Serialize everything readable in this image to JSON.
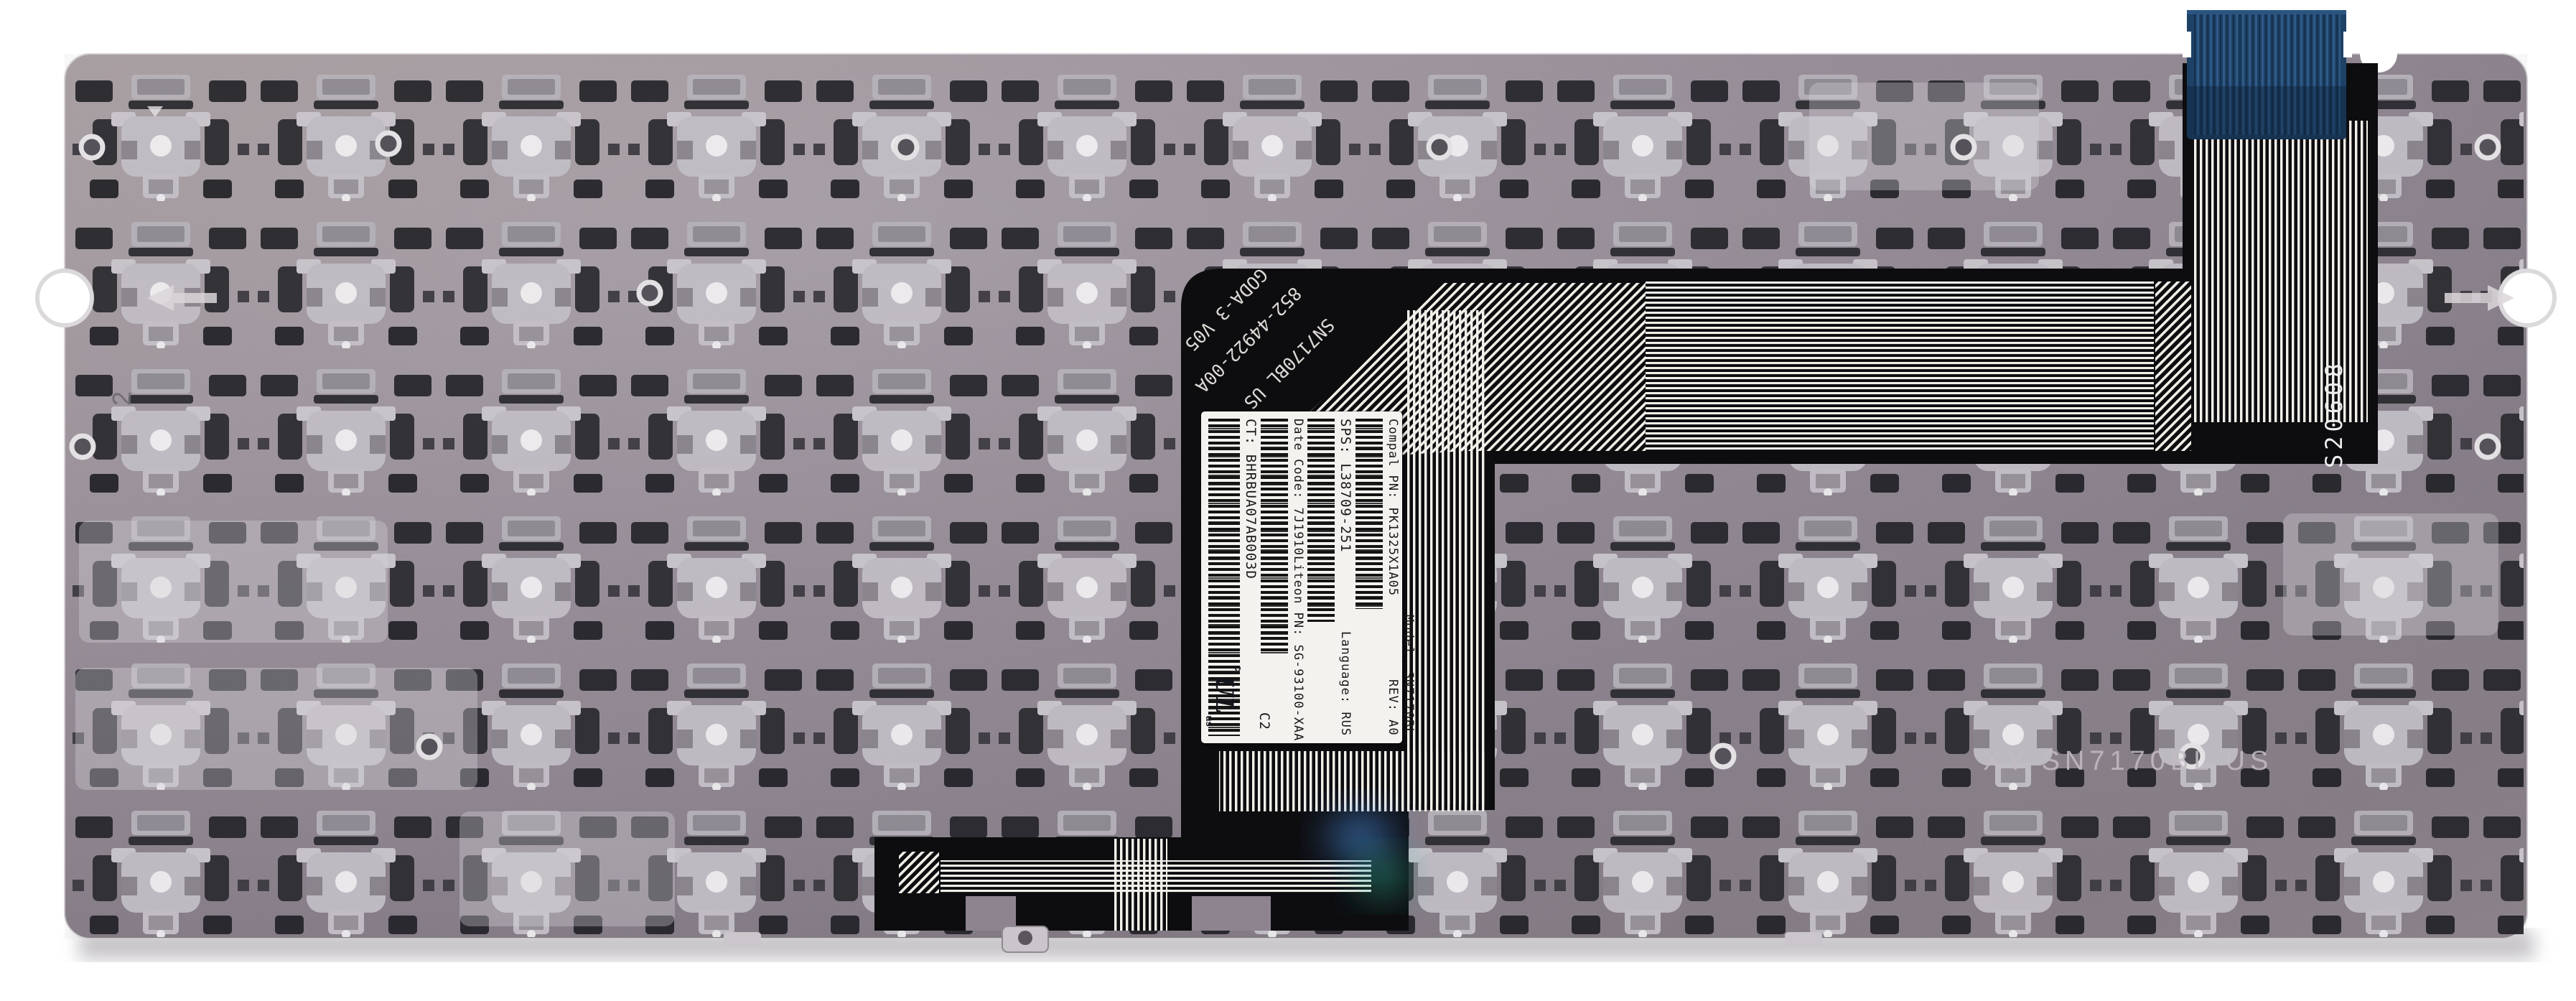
{
  "label": {
    "compal_pn": "Compal PN: PK1325X1A05",
    "sps": "SPS: L38709-251",
    "date_code": "Date Code: 7J1910",
    "liteon_pn": "Liteon PN: SG-93100-XAA",
    "ct": "CT: BHRBUA07AB003D",
    "model": "Model: SN7170BL",
    "rev": "REV: A0",
    "language": "Language: RUS",
    "cert_mark": "C2",
    "ul_text": "UL",
    "ul_c": "c",
    "ul_us": "us"
  },
  "flex_print": {
    "line1": "GODA-3 V05",
    "line2": "852-44922-00A",
    "line3": "SN7170BL US",
    "serial": "S20608"
  },
  "plate": {
    "stamp": "XY SN7170BL US",
    "edge_mark": "2"
  },
  "colors": {
    "plate_gray": "#8d8490",
    "cable_black": "#0d0d10",
    "trace_white": "#f2efe9",
    "connector_blue": "#1e4166",
    "label_white": "#f4f2ef"
  }
}
